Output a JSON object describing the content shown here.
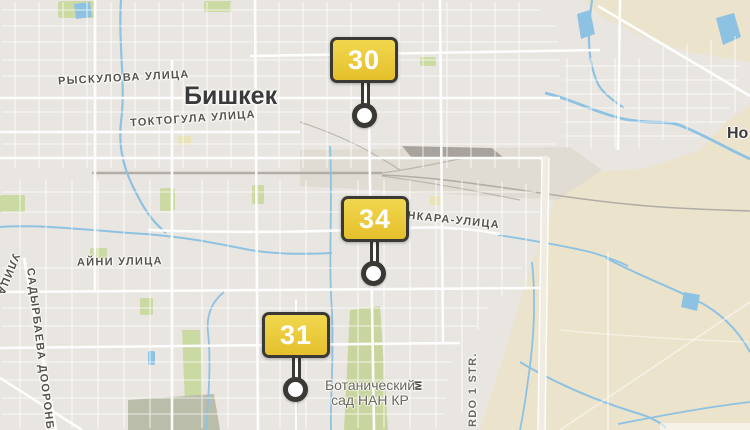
{
  "map": {
    "city": {
      "label": "Бишкек"
    },
    "partial_town": {
      "label": "Но"
    },
    "streets": {
      "ryskulova": "РЫСКУЛОВА УЛИЦА",
      "toktogula": "ТОКТОГУЛА УЛИЦА",
      "aini": "АЙНИ УЛИЦА",
      "ankara": "АНКАРА-УЛИЦА",
      "sadyrbaeva": "САДЫРБАЕВА ДООРОНБЕК",
      "ulitsa_fragment": "УЛИЦА",
      "rdo": "RDO 1 STR.",
      "m_fragment": "М"
    },
    "poi": {
      "botanical_line1": "Ботанический",
      "botanical_line2": "сад НАН КР"
    },
    "colors": {
      "land": "#e9e6e1",
      "suburb": "#ece3cc",
      "water": "#8ec2e2",
      "park": "#cbd9a3",
      "railway": "#b2ada6",
      "street": "#ffffff",
      "marker_fill": "#eccb3a",
      "marker_border": "#3b3935",
      "marker_text": "#ffffff"
    }
  },
  "markers": [
    {
      "label": "30"
    },
    {
      "label": "34"
    },
    {
      "label": "31"
    }
  ]
}
